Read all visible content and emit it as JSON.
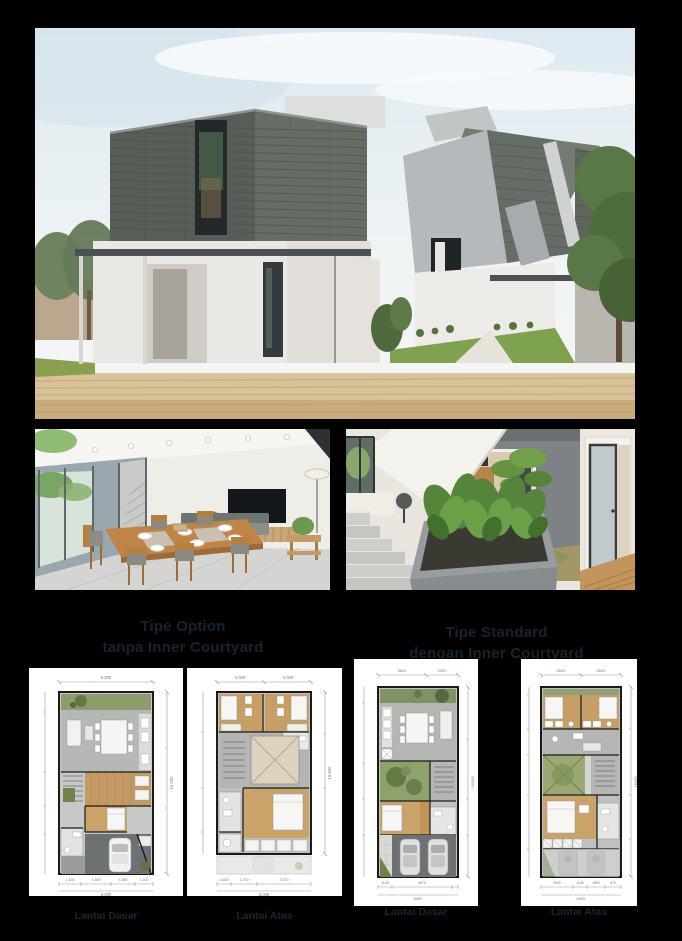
{
  "page": {
    "background": "#000000",
    "card_background": "#ffffff"
  },
  "colors": {
    "heading_text": "#15242e",
    "caption_text": "#1b2531",
    "slate": "#5a615a",
    "stucco": "#b6b9bb",
    "lawn": "#7fa24e",
    "paving": "#d9c298",
    "wood_floor": "#c9a36a",
    "courtyard_green": "#8ea26b"
  },
  "sections": [
    {
      "id": "option",
      "title_line1": "Tipe Option",
      "title_line2": "tanpa Inner Courtyard",
      "plans": [
        {
          "caption": "Lantai Dasar",
          "dims": {
            "top": [
              "6.000"
            ],
            "right": "16.000",
            "bottom": [
              "1.150",
              "1.850",
              "1.800",
              "1.200"
            ],
            "bottom_total": "6.000"
          }
        },
        {
          "caption": "Lantai Atas",
          "dims": {
            "top": [
              "3.000",
              "3.000"
            ],
            "right": "15.800",
            "bottom": [
              "0.600",
              "1.700",
              "3.700"
            ],
            "bottom_total": "6.000"
          }
        }
      ]
    },
    {
      "id": "standard",
      "title_line1": "Tipe Standard",
      "title_line2": "dengan Inner Courtyard",
      "plans": [
        {
          "caption": "Lantai Dasar",
          "dims": {
            "top": [
              "3600",
              "2000"
            ],
            "right": "16000",
            "bottom": [
              "1125",
              "4875"
            ],
            "bottom_total": "6000"
          }
        },
        {
          "caption": "Lantai Atas",
          "dims": {
            "top": [
              "3000",
              "3000"
            ],
            "right": "15000",
            "bottom": [
              "2625",
              "1150",
              "1550",
              "675"
            ],
            "bottom_total": "6000"
          }
        }
      ]
    }
  ]
}
